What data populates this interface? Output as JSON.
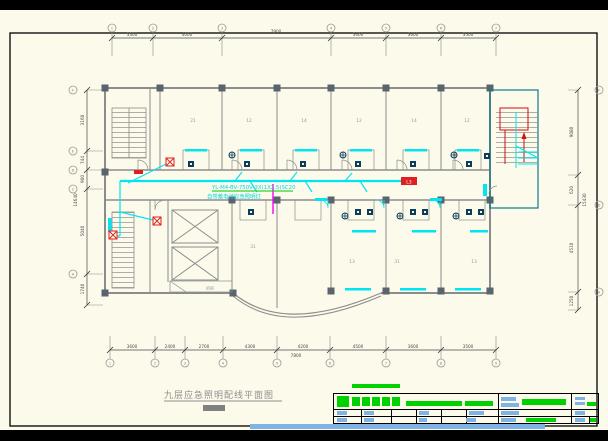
{
  "colors": {
    "paper": "#FCFAEA",
    "wall_grey": "#8C8C8C",
    "column_grey": "#59646C",
    "wire_cyan": "#00E5F2",
    "symbol_red": "#E02020",
    "riser_magenta": "#FF00FF",
    "fixture_navy": "#0E3D5C",
    "stair_teal": "#0F7A8A",
    "titleblock_green": "#00D200",
    "titleblock_blue": "#7FB2E5"
  },
  "plan": {
    "title": "九层应急照明配线平面图",
    "wire_spec": "YL-M4-BV-750V-3X(1X2.5)SC20",
    "wire_note": "自带蓄电池应急照明灯",
    "feeder_label": "L3",
    "machine_room_label": "机房",
    "rooms": {
      "top": [
        "21",
        "12",
        "14",
        "12",
        "14",
        "12"
      ],
      "bottom": [
        "13",
        "31",
        "13"
      ],
      "left": [
        "31"
      ]
    }
  },
  "dims": {
    "top": {
      "bubbles": [
        "1",
        "2",
        "3",
        "4",
        "5",
        "6",
        "7"
      ],
      "segs": [
        "3300",
        "4000",
        "7900",
        "3600",
        "3600",
        "3500"
      ]
    },
    "bottom": {
      "bubbles": [
        "1",
        "2",
        "3",
        "4",
        "5",
        "6",
        "7",
        "8",
        "9"
      ],
      "segs": [
        "3600",
        "2400",
        "2700",
        "4300",
        "4200",
        "4500",
        "3600",
        "3500"
      ],
      "tier2": "7800"
    },
    "left": {
      "bubbles": [
        "F",
        "E",
        "D",
        "C",
        "A"
      ],
      "segs": [
        "3160",
        "744",
        "900",
        "5040",
        "1740"
      ],
      "overall": "14640"
    },
    "right": {
      "bubbles": [
        "F",
        "D",
        "A"
      ],
      "segs": [
        "9080",
        "620",
        "4510",
        "1250"
      ],
      "overall": "15430"
    }
  }
}
